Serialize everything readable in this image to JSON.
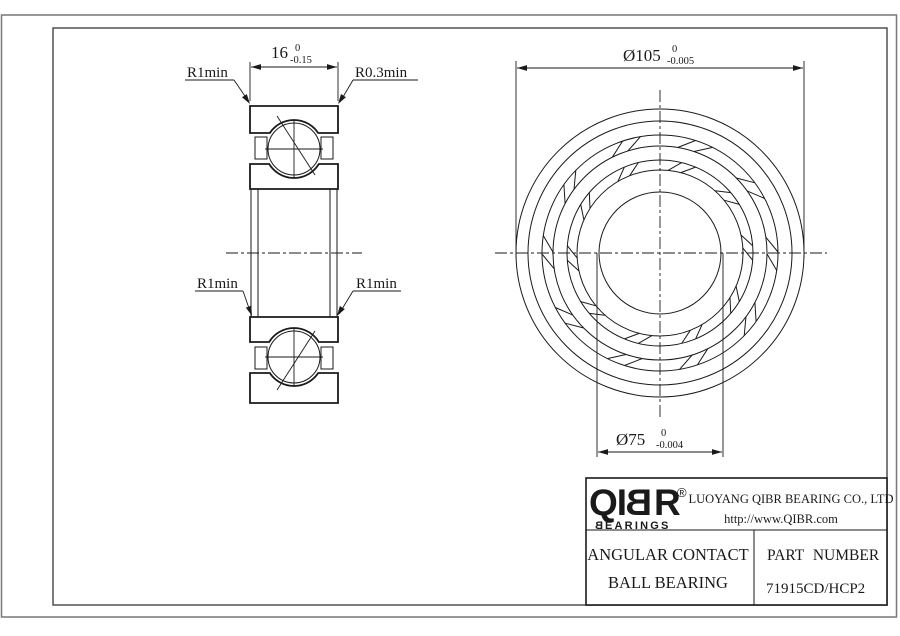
{
  "drawing_labels": {
    "width_dim": {
      "value": "16",
      "tol_upper": "0",
      "tol_lower": "-0.15"
    },
    "od_dim": {
      "value": "Ø105",
      "tol_upper": "0",
      "tol_lower": "-0.005"
    },
    "bore_dim": {
      "value": "Ø75",
      "tol_upper": "0",
      "tol_lower": "-0.004"
    },
    "radius_labels": {
      "top_left": "R1min",
      "top_right": "R0.3min",
      "mid_left": "R1min",
      "mid_right": "R1min"
    }
  },
  "title_block": {
    "logo": {
      "prefix": "QI",
      "mirrored_b": "B",
      "suffix": "R",
      "registered": "®",
      "sub_mirrored_b": "B",
      "sub_rest": "EARINGS"
    },
    "company_name": "LUOYANG QIBR BEARING CO., LTD",
    "website": "http://www.QIBR.com",
    "product_type_line1": "ANGULAR CONTACT",
    "product_type_line2": "BALL BEARING",
    "part_number_label": "PART NUMBER",
    "part_number": "71915CD/HCP2"
  }
}
